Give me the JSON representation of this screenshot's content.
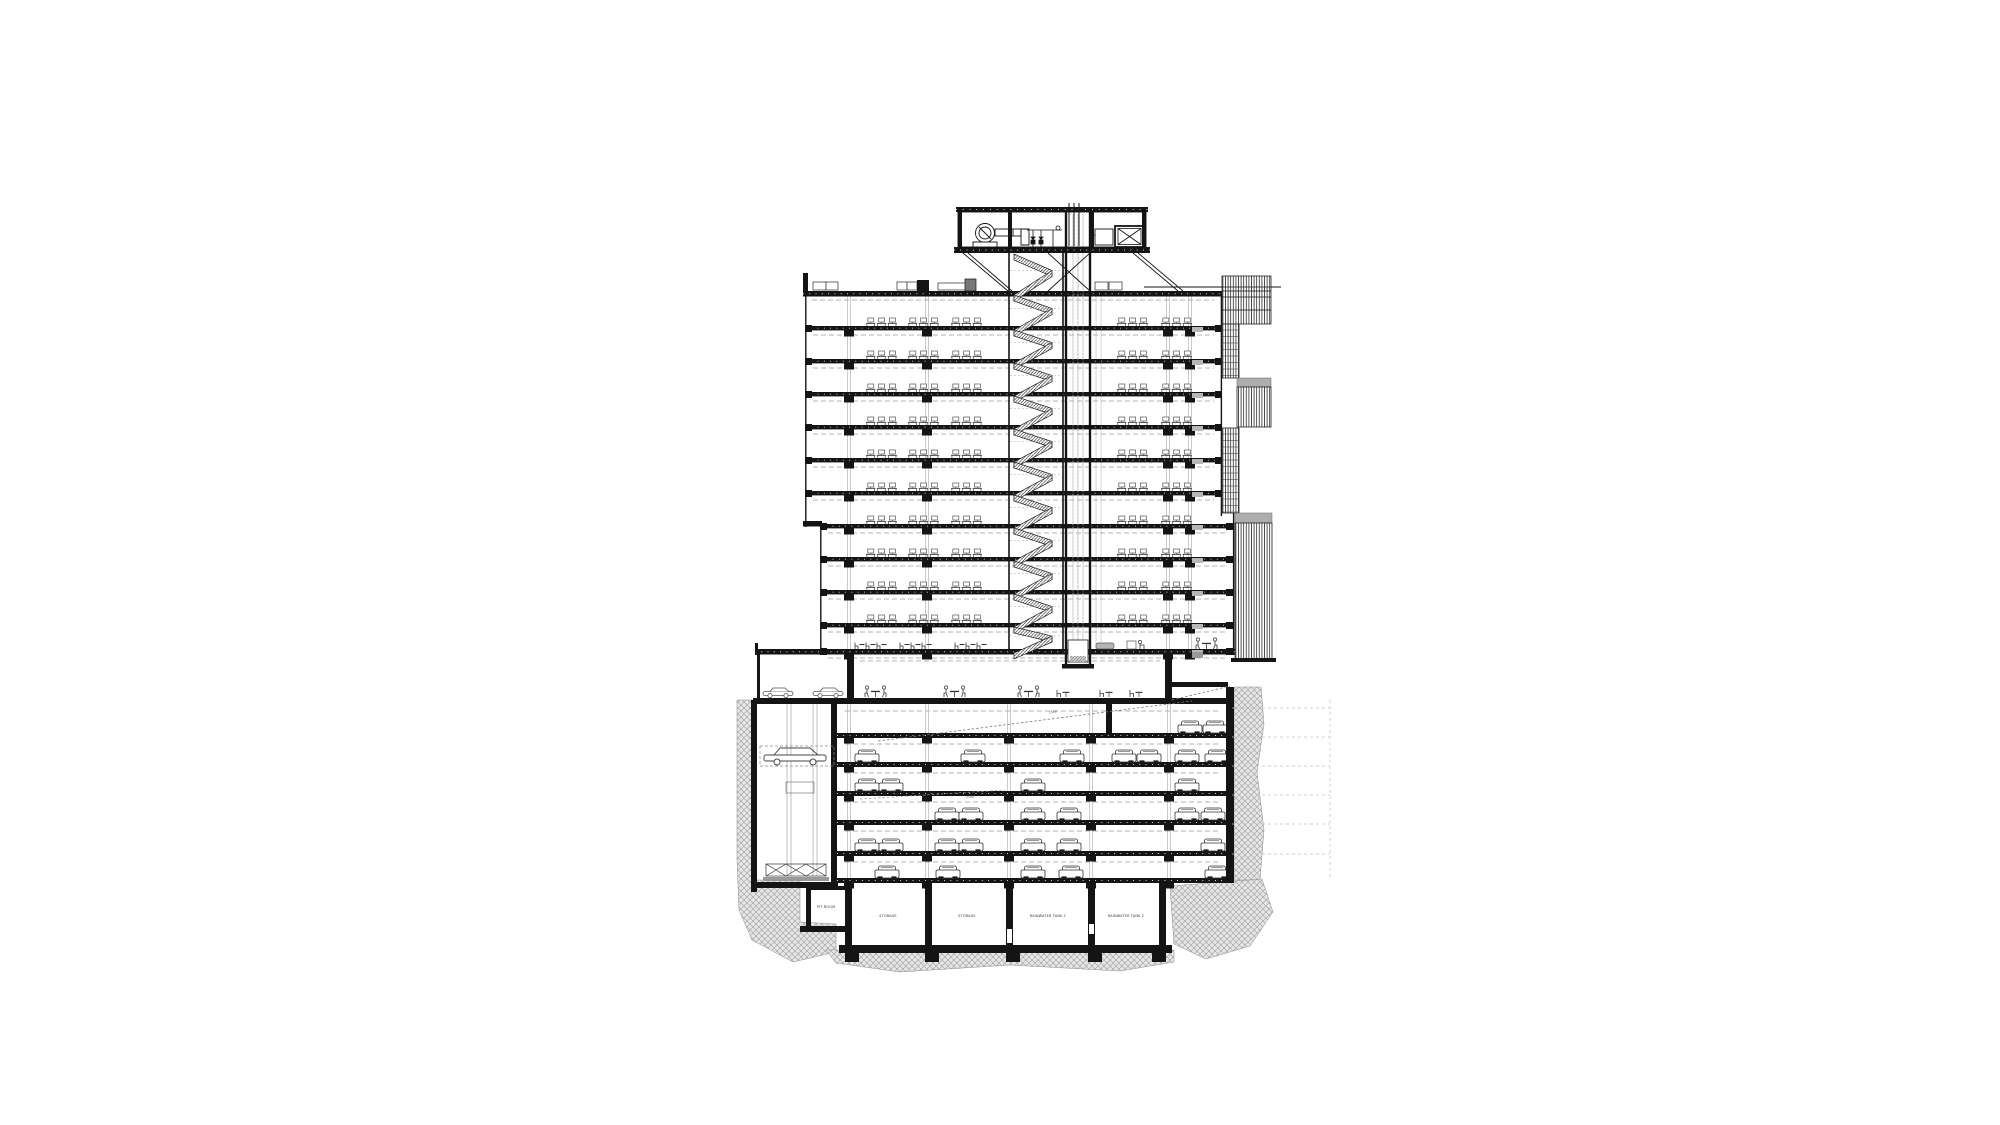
{
  "drawing": {
    "type": "architectural-building-cross-section",
    "annotations": {
      "ramp_label_1": "2500",
      "ramp_label_2": "2500"
    },
    "rooms": [
      {
        "label": "PIT ROOM"
      },
      {
        "label": "STORAGE"
      },
      {
        "label": "STORAGE"
      },
      {
        "label": "RAINWATER TANK 1"
      },
      {
        "label": "RAINWATER TANK 2"
      }
    ],
    "colors": {
      "ink": "#141414",
      "dash_gray": "#9a9a9a",
      "light_gray": "#c0c0c0",
      "earth_line": "#9b9b9b",
      "earth_bg": "#e4e4e4",
      "panel_gray": "#adadad",
      "mid_gray": "#8a8a8a"
    },
    "tower": {
      "slab_ys": [
        291,
        326,
        359,
        392,
        425,
        458,
        491,
        524,
        557,
        590,
        623,
        649
      ],
      "upper_left_x": 805,
      "lower_left_x": 820,
      "left_split_index": 7,
      "upper_right_x": 1222,
      "lower_right_x": 1233,
      "right_split_index": 7,
      "desk_floor_count": 10,
      "left_desk_clusters": [
        866,
        908,
        951
      ],
      "right_desk_clusters": [
        1117,
        1161
      ],
      "column_xs": [
        849,
        927,
        1168,
        1190
      ],
      "riser_xs": [
        1096,
        1101
      ]
    },
    "core": {
      "stair_left_x": 1008,
      "stair_right_x": 1064,
      "elev_left_x": 1066,
      "elev_right_x": 1090,
      "elev_top_y": 212,
      "elev_bottom_y": 666,
      "stair_top_y": 250,
      "stair_bottom_y": 649
    },
    "parking": {
      "deck_ys": [
        733,
        762,
        791,
        820,
        851,
        878
      ],
      "left_x": 837,
      "right_x": 1226,
      "column_xs": [
        849,
        927,
        1009,
        1091,
        1169
      ],
      "cars": {
        "733": [
          1178,
          1203
        ],
        "762": [
          855,
          961,
          1060,
          1112,
          1137,
          1175,
          1205
        ],
        "791": [
          855,
          879,
          1021,
          1175
        ],
        "820": [
          935,
          959,
          1021,
          1057,
          1175,
          1201
        ],
        "851": [
          855,
          879,
          935,
          959,
          1021,
          1057,
          1201
        ],
        "878": [
          875,
          936,
          1021,
          1059,
          1205
        ]
      },
      "anchor_ys": [
        708,
        737,
        766,
        795,
        824,
        854
      ],
      "street_cars": [
        763,
        813
      ]
    },
    "ground": {
      "table_groups": [
        865,
        944,
        1018
      ],
      "single_chairs": [
        1057,
        1100,
        1130
      ]
    },
    "cafe": {
      "clusters": [
        855,
        900,
        955
      ]
    }
  }
}
